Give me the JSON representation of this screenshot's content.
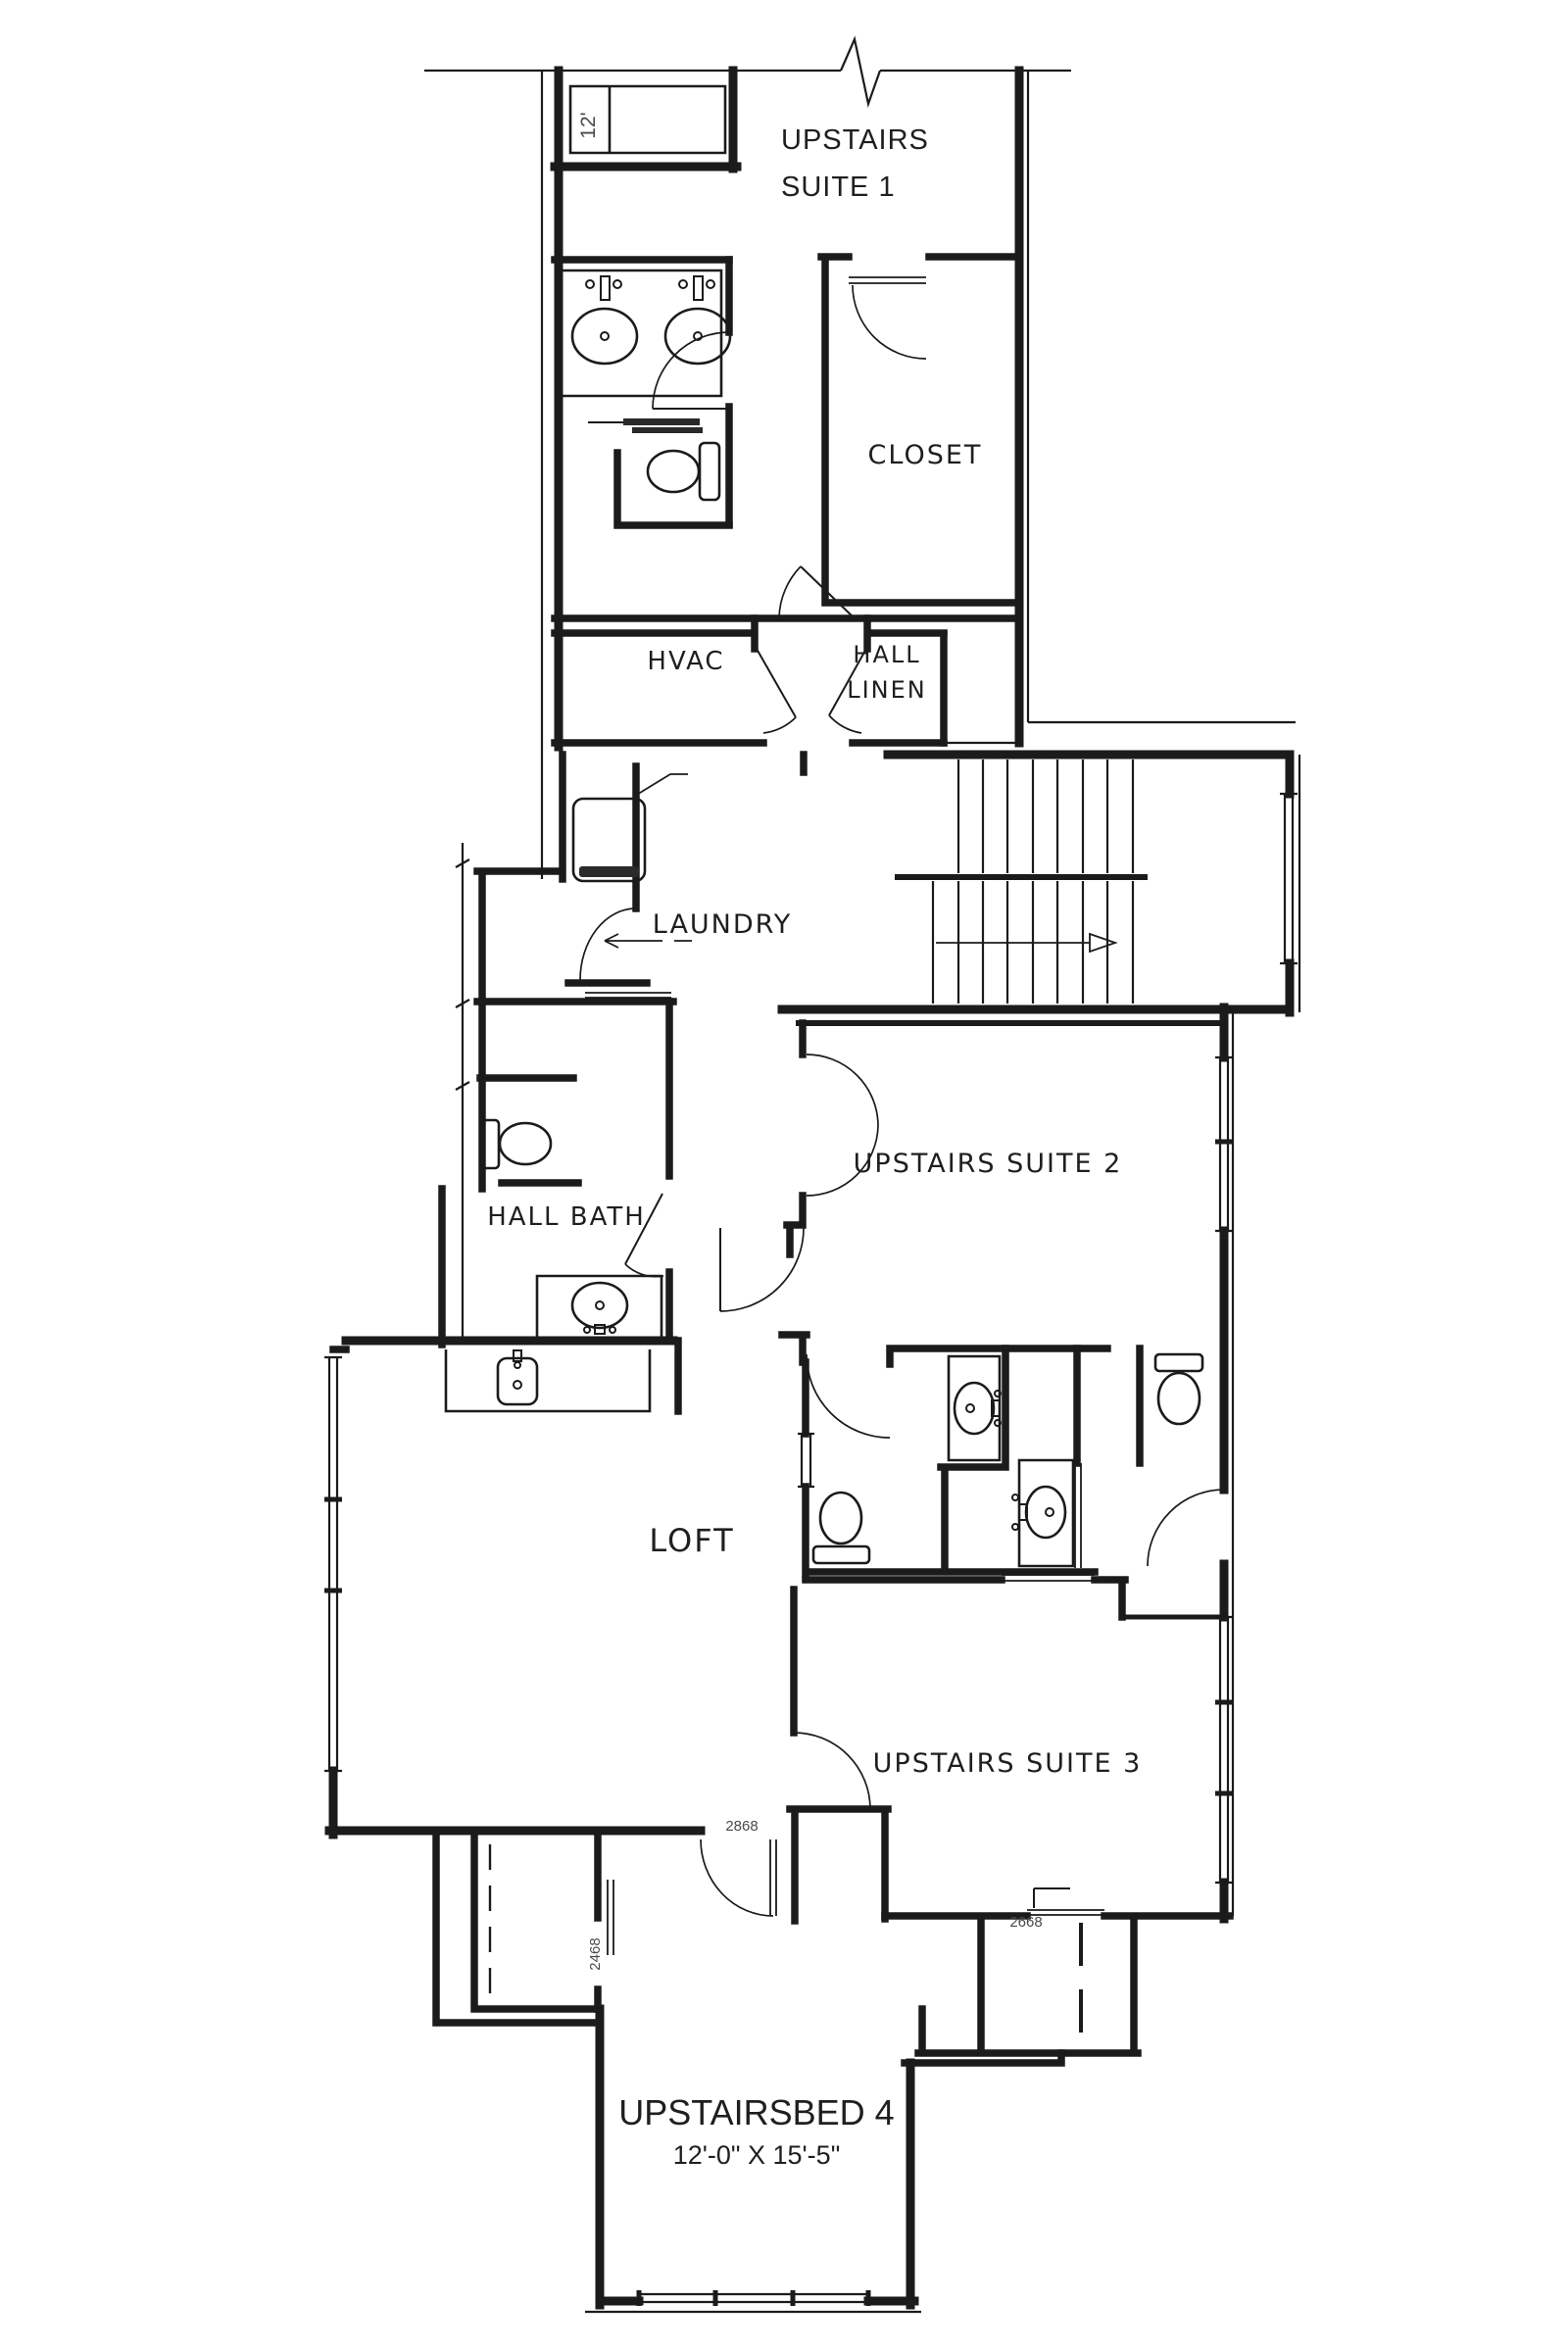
{
  "drawing": {
    "type": "architectural-floor-plan",
    "floor": "second-floor",
    "colors": {
      "ink": "#1b1b1b",
      "paper": "#ffffff",
      "dim_text": "#4a4a4a"
    },
    "rooms": {
      "suite1_line1": "UPSTAIRS",
      "suite1_line2": "SUITE 1",
      "closet": "CLOSET",
      "hvac": "HVAC",
      "hall_linen_line1": "HALL",
      "hall_linen_line2": "LINEN",
      "laundry": "LAUNDRY",
      "suite2": "UPSTAIRS SUITE 2",
      "hall_bath": "HALL BATH",
      "loft": "LOFT",
      "suite3": "UPSTAIRS SUITE 3",
      "bed4": "UPSTAIRSBED 4",
      "bed4_dim": "12'-0\" X 15'-5\""
    },
    "door_labels": {
      "bed4_hall_door": "2868",
      "bed4_closet_door": "2468",
      "suite3_closet_door": "2668"
    },
    "dims": {
      "shower": "12'"
    }
  }
}
